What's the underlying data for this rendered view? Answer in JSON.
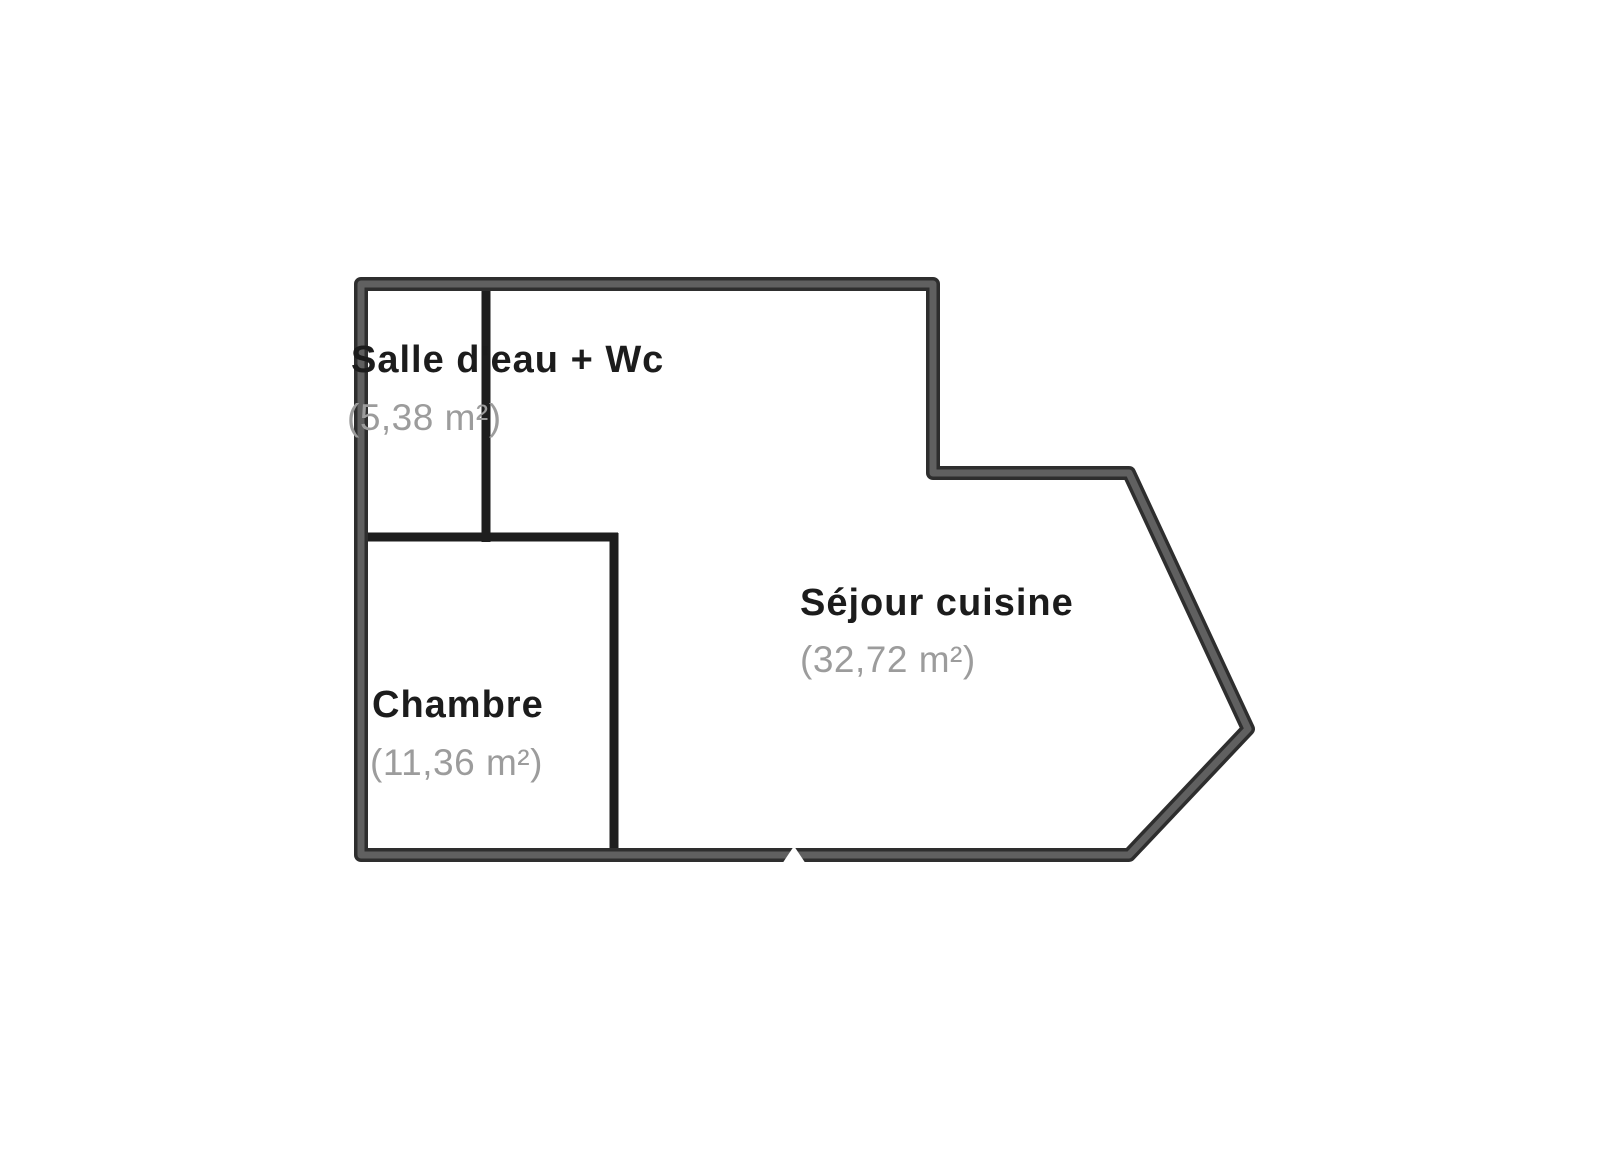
{
  "floorplan": {
    "rooms": [
      {
        "id": "salle-eau-wc",
        "name": "Salle d'eau + Wc",
        "area": "(5,38 m²)"
      },
      {
        "id": "chambre",
        "name": "Chambre",
        "area": "(11,36 m²)"
      },
      {
        "id": "sejour-cuisine",
        "name": "Séjour cuisine",
        "area": "(32,72 m²)"
      }
    ],
    "colors": {
      "background": "#ffffff",
      "exterior_wall_outline": "#2e2e2e",
      "exterior_wall_core": "#606060",
      "interior_wall": "#1e1e1e",
      "room_name_text": "#1c1c1c",
      "room_area_text": "#9c9c9c"
    }
  }
}
